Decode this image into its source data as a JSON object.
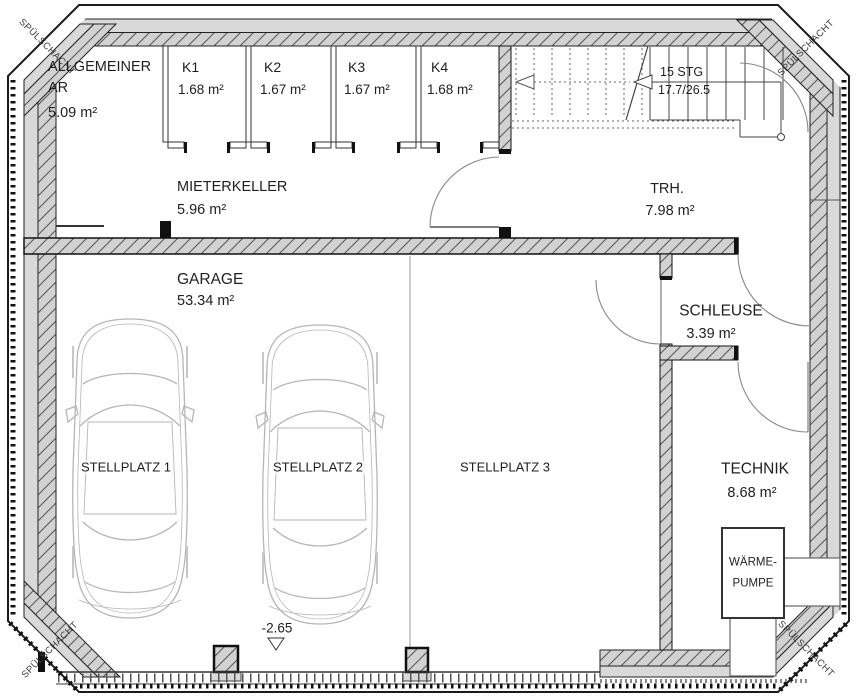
{
  "drawing": {
    "shaft_label": "SPÜLSCHACHT",
    "level_marker": "-2.65"
  },
  "rooms": {
    "allgemeiner_ar": {
      "line1": "ALLGEMEINER",
      "line2": "AR",
      "area": "5.09 m²"
    },
    "k1": {
      "name": "K1",
      "area": "1.68 m²"
    },
    "k2": {
      "name": "K2",
      "area": "1.67 m²"
    },
    "k3": {
      "name": "K3",
      "area": "1.67 m²"
    },
    "k4": {
      "name": "K4",
      "area": "1.68 m²"
    },
    "mieterkeller": {
      "name": "MIETERKELLER",
      "area": "5.96 m²"
    },
    "trh": {
      "name": "TRH.",
      "area": "7.98 m²"
    },
    "garage": {
      "name": "GARAGE",
      "area": "53.34 m²"
    },
    "schleuse": {
      "name": "SCHLEUSE",
      "area": "3.39 m²"
    },
    "technik": {
      "name": "TECHNIK",
      "area": "8.68 m²"
    }
  },
  "stairs": {
    "line1": "15 STG",
    "line2": "17.7/26.5"
  },
  "parking": {
    "p1": "STELLPLATZ 1",
    "p2": "STELLPLATZ 2",
    "p3": "STELLPLATZ 3"
  },
  "equipment": {
    "heat_pump_line1": "WÄRME-",
    "heat_pump_line2": "PUMPE"
  },
  "colors": {
    "wall_gray": "#d9d9d9",
    "hatch_bg": "#d2d2d2",
    "hatch_line": "#5a5a5a",
    "car_line": "#b6b6b6"
  }
}
